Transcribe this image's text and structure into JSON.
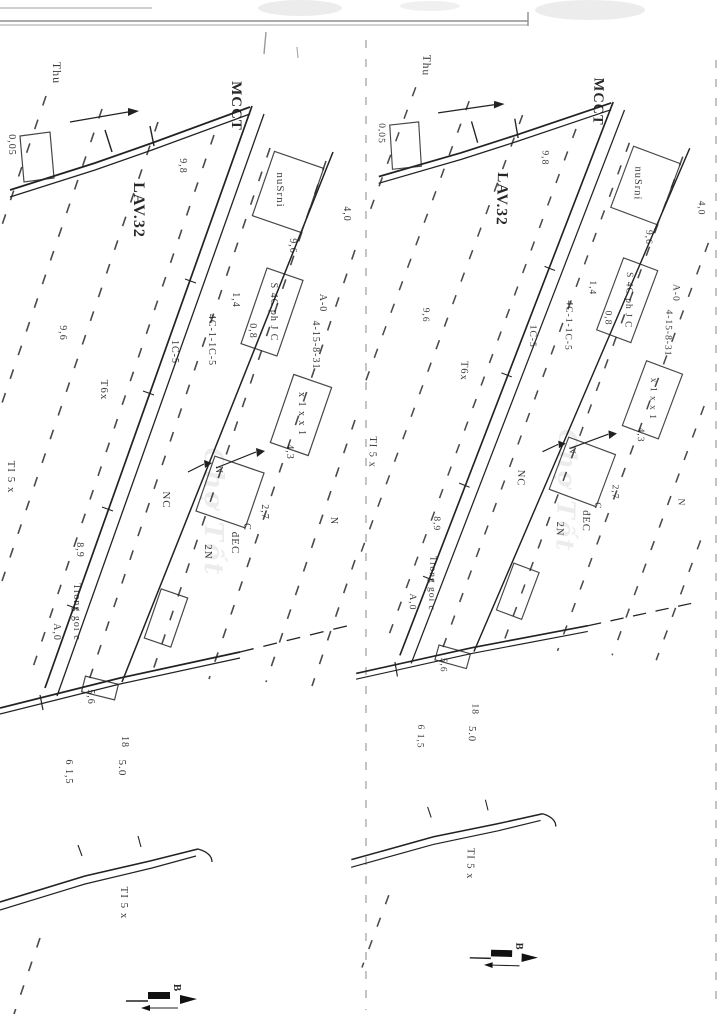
{
  "scan": {
    "watermark": "Chợ Tốt",
    "north_label": "B",
    "labels": [
      {
        "text": "Thu",
        "x": 53,
        "y": 73,
        "size": 12,
        "bold": false
      },
      {
        "text": "MCCT",
        "x": 232,
        "y": 106,
        "size": 15,
        "bold": true
      },
      {
        "text": "LAV.32",
        "x": 134,
        "y": 210,
        "size": 16,
        "bold": true
      },
      {
        "text": "9,8",
        "x": 180,
        "y": 166,
        "size": 10,
        "bold": false
      },
      {
        "text": "nuSrni",
        "x": 277,
        "y": 190,
        "size": 11,
        "bold": false
      },
      {
        "text": "9,6",
        "x": 290,
        "y": 246,
        "size": 10,
        "bold": false
      },
      {
        "text": "4,0",
        "x": 344,
        "y": 214,
        "size": 10,
        "bold": false
      },
      {
        "text": "S 4C ph J C",
        "x": 271,
        "y": 312,
        "size": 10,
        "bold": false
      },
      {
        "text": "4C-1-1C-5",
        "x": 209,
        "y": 340,
        "size": 10,
        "bold": false
      },
      {
        "text": "1C-5",
        "x": 172,
        "y": 352,
        "size": 10,
        "bold": false
      },
      {
        "text": "1,4",
        "x": 233,
        "y": 300,
        "size": 10,
        "bold": false
      },
      {
        "text": "0,8",
        "x": 250,
        "y": 331,
        "size": 10,
        "bold": false
      },
      {
        "text": "A-0",
        "x": 320,
        "y": 303,
        "size": 10,
        "bold": false
      },
      {
        "text": "4-15-8-31",
        "x": 313,
        "y": 345,
        "size": 10,
        "bold": false
      },
      {
        "text": "x 1 x x 1",
        "x": 299,
        "y": 414,
        "size": 10,
        "bold": false
      },
      {
        "text": "4,3",
        "x": 287,
        "y": 452,
        "size": 10,
        "bold": false
      },
      {
        "text": "9,6",
        "x": 60,
        "y": 333,
        "size": 10,
        "bold": false
      },
      {
        "text": "T6x",
        "x": 101,
        "y": 390,
        "size": 11,
        "bold": false
      },
      {
        "text": "0,05",
        "x": 9,
        "y": 145,
        "size": 10,
        "bold": false
      },
      {
        "text": "TI 5 x",
        "x": 8,
        "y": 477,
        "size": 11,
        "bold": false
      },
      {
        "text": "N",
        "x": 216,
        "y": 470,
        "size": 10,
        "bold": false
      },
      {
        "text": "NC",
        "x": 163,
        "y": 500,
        "size": 11,
        "bold": false
      },
      {
        "text": "2N",
        "x": 205,
        "y": 552,
        "size": 11,
        "bold": false
      },
      {
        "text": "đEC",
        "x": 232,
        "y": 543,
        "size": 11,
        "bold": false
      },
      {
        "text": "C",
        "x": 244,
        "y": 527,
        "size": 10,
        "bold": false
      },
      {
        "text": "2,7",
        "x": 262,
        "y": 512,
        "size": 10,
        "bold": false
      },
      {
        "text": "N",
        "x": 331,
        "y": 521,
        "size": 10,
        "bold": false
      },
      {
        "text": "8,9",
        "x": 77,
        "y": 550,
        "size": 10,
        "bold": false
      },
      {
        "text": "Trong goi c",
        "x": 74,
        "y": 612,
        "size": 10,
        "bold": false
      },
      {
        "text": "A,0",
        "x": 54,
        "y": 632,
        "size": 10,
        "bold": false
      },
      {
        "text": "5,6",
        "x": 88,
        "y": 697,
        "size": 10,
        "bold": false
      },
      {
        "text": "6 1,5",
        "x": 66,
        "y": 772,
        "size": 10,
        "bold": false
      },
      {
        "text": "5.0",
        "x": 119,
        "y": 768,
        "size": 11,
        "bold": false
      },
      {
        "text": "18",
        "x": 122,
        "y": 742,
        "size": 10,
        "bold": false
      },
      {
        "text": "TI 5 x",
        "x": 121,
        "y": 903,
        "size": 11,
        "bold": false
      }
    ]
  }
}
